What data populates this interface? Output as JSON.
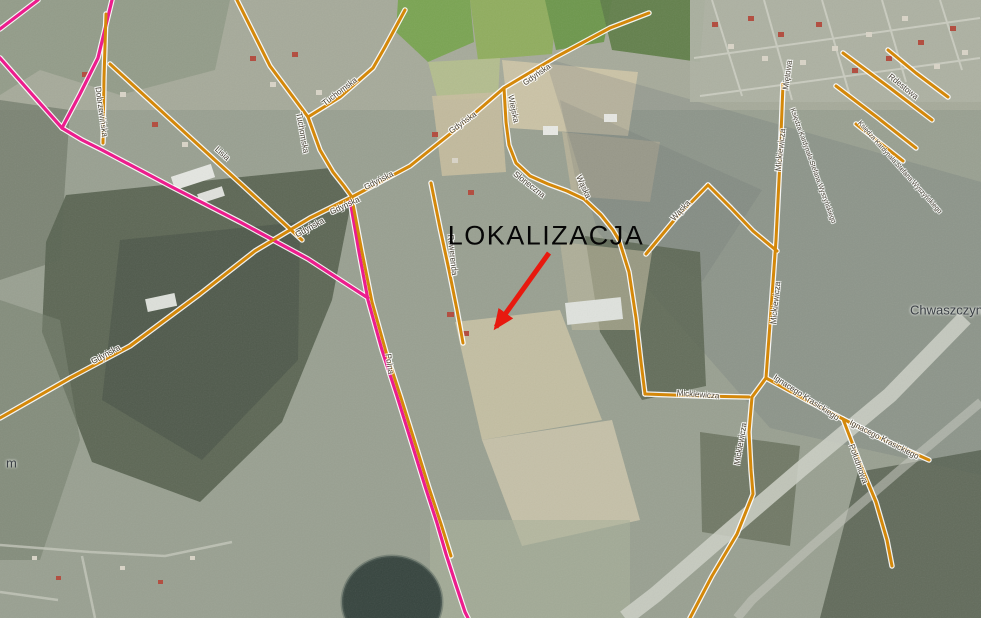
{
  "map": {
    "colors": {
      "road_orange": "#d4880a",
      "road_pink": "#ec1d8d",
      "road_casing": "#ffffff",
      "arrow_red": "#e8190f",
      "street_label_text": "#4a4438"
    },
    "annotation": {
      "label": "LOKALIZACJA",
      "x": 546,
      "y": 236,
      "arrow": {
        "x1": 549,
        "y1": 253,
        "x2": 496,
        "y2": 327
      }
    },
    "place_labels": [
      {
        "name": "place-chwaszczyno",
        "text": "Chwaszczyno",
        "x": 910,
        "y": 310
      },
      {
        "name": "place-partial-left-edge",
        "text": "m",
        "x": 6,
        "y": 463
      }
    ],
    "street_labels": [
      {
        "text": "Dobrzewińska",
        "x": 101,
        "y": 112,
        "rot": 82
      },
      {
        "text": "Lisia",
        "x": 222,
        "y": 154,
        "rot": 42
      },
      {
        "text": "Tuchomska",
        "x": 340,
        "y": 92,
        "rot": -37
      },
      {
        "text": "Tuchomska",
        "x": 302,
        "y": 133,
        "rot": 80
      },
      {
        "text": "Gdyńska",
        "x": 310,
        "y": 228,
        "rot": -29
      },
      {
        "text": "Gdyńska",
        "x": 345,
        "y": 206,
        "rot": -25
      },
      {
        "text": "Gdyńska",
        "x": 379,
        "y": 181,
        "rot": -27
      },
      {
        "text": "Gdyńska",
        "x": 463,
        "y": 123,
        "rot": -36
      },
      {
        "text": "Gdyńska",
        "x": 537,
        "y": 75,
        "rot": -35
      },
      {
        "text": "Gdyńska",
        "x": 106,
        "y": 355,
        "rot": -28
      },
      {
        "text": "Polna",
        "x": 389,
        "y": 364,
        "rot": 82
      },
      {
        "text": "Rewerenda",
        "x": 452,
        "y": 255,
        "rot": 84
      },
      {
        "text": "Wiejska",
        "x": 513,
        "y": 109,
        "rot": 78
      },
      {
        "text": "Słoneczna",
        "x": 529,
        "y": 185,
        "rot": 38
      },
      {
        "text": "Wąska",
        "x": 583,
        "y": 187,
        "rot": 66
      },
      {
        "text": "Wąska",
        "x": 681,
        "y": 211,
        "rot": -47
      },
      {
        "text": "Miętowa",
        "x": 788,
        "y": 75,
        "rot": -82
      },
      {
        "text": "Mickiewicza",
        "x": 781,
        "y": 150,
        "rot": -84
      },
      {
        "text": "Mickiewicza",
        "x": 776,
        "y": 303,
        "rot": -84
      },
      {
        "text": "Mickiewicza",
        "x": 698,
        "y": 395,
        "rot": 4
      },
      {
        "text": "Mickiewicza",
        "x": 741,
        "y": 444,
        "rot": -80
      },
      {
        "text": "Ignacego Krasickiego",
        "x": 806,
        "y": 398,
        "rot": 33
      },
      {
        "text": "Ignacego Krasickiego",
        "x": 884,
        "y": 440,
        "rot": 27
      },
      {
        "text": "Południowa",
        "x": 858,
        "y": 464,
        "rot": 70
      },
      {
        "text": "Księdza Kardynała Stefana Wyszyńskiego",
        "x": 812,
        "y": 166,
        "rot": 70,
        "small": true
      },
      {
        "text": "Księdza Kardynała Stefana Wyszyńskiego",
        "x": 899,
        "y": 168,
        "rot": 48,
        "small": true
      },
      {
        "text": "Rdestowa",
        "x": 903,
        "y": 87,
        "rot": 39
      }
    ],
    "roads": [
      {
        "name": "road-gdynska-sw",
        "kind": "orange",
        "pts": "0,418 70,378 130,346 200,294 255,251 310,218 352,197"
      },
      {
        "name": "road-gdynska-ne",
        "kind": "orange",
        "pts": "352,197 410,166 460,126 504,88 556,57 610,28 649,13"
      },
      {
        "name": "road-tuchomska-nw",
        "kind": "orange",
        "pts": "237,0 270,66 308,117"
      },
      {
        "name": "road-tuchomska-n",
        "kind": "orange",
        "pts": "405,10 385,47 373,68 340,97 308,117"
      },
      {
        "name": "road-tuchomska-s",
        "kind": "orange",
        "pts": "308,117 320,150 333,172 344,186 352,197"
      },
      {
        "name": "road-dobrzewinska",
        "kind": "orange",
        "pts": "106,14 104,78 103,143"
      },
      {
        "name": "road-lisia",
        "kind": "orange",
        "pts": "110,64 170,119 240,183 302,240"
      },
      {
        "name": "road-polna-orange",
        "kind": "orange",
        "pts": "352,199 362,252 372,302 386,352 401,398 416,446 429,488 441,524 451,556"
      },
      {
        "name": "road-rewerenda",
        "kind": "orange",
        "pts": "431,183 440,228 449,270 457,310 463,343"
      },
      {
        "name": "road-wiejska-sloneczna",
        "kind": "orange",
        "pts": "504,88 506,122 509,145 516,163 530,176 548,184 567,191 584,199 601,215 613,230 619,240"
      },
      {
        "name": "road-mid-ns",
        "kind": "orange",
        "pts": "619,240 629,272 636,318 641,362 645,394"
      },
      {
        "name": "road-waska-left",
        "kind": "orange",
        "pts": "646,254 676,218 708,185"
      },
      {
        "name": "road-waska-right",
        "kind": "orange",
        "pts": "708,185 731,208 753,231 777,251"
      },
      {
        "name": "road-mickiewicza-n",
        "kind": "orange",
        "pts": "783,84 780,160 776,240 771,310 766,378"
      },
      {
        "name": "road-mickiewicza-s",
        "kind": "orange",
        "pts": "766,378 752,397 749,432 751,470 753,494 737,534 712,576 690,618"
      },
      {
        "name": "road-mickiewicza-w",
        "kind": "orange",
        "pts": "645,394 700,396 749,397"
      },
      {
        "name": "road-krasickiego-1",
        "kind": "orange",
        "pts": "766,378 806,400 843,419"
      },
      {
        "name": "road-krasickiego-2",
        "kind": "orange",
        "pts": "843,419 882,439 929,460"
      },
      {
        "name": "road-poludniowa",
        "kind": "orange",
        "pts": "843,419 861,466 876,502 887,540 892,566"
      },
      {
        "name": "road-wyszynskiego-a",
        "kind": "orange",
        "pts": "843,53 890,88 932,120"
      },
      {
        "name": "road-wyszynskiego-b",
        "kind": "orange",
        "pts": "836,86 878,118 916,148"
      },
      {
        "name": "road-wyszynskiego-c",
        "kind": "orange",
        "pts": "856,124 880,143 903,161"
      },
      {
        "name": "road-rdestowa",
        "kind": "orange",
        "pts": "888,50 916,73 948,97"
      },
      {
        "name": "road-pink-corner",
        "kind": "pink",
        "pts": "38,0 0,29"
      },
      {
        "name": "road-pink-west",
        "kind": "pink",
        "pts": "0,58 30,92 62,128"
      },
      {
        "name": "road-pink-north",
        "kind": "pink",
        "pts": "112,0 98,58 80,94 62,128"
      },
      {
        "name": "road-pink-diagonal",
        "kind": "pink",
        "pts": "62,128 82,140 102,150 170,186 240,222 308,259 368,298"
      },
      {
        "name": "road-pink-polna",
        "kind": "pink",
        "pts": "350,200 359,252 368,300 382,350 397,396 412,444 425,486 437,523 446,554 456,585 465,612 468,618"
      }
    ]
  }
}
